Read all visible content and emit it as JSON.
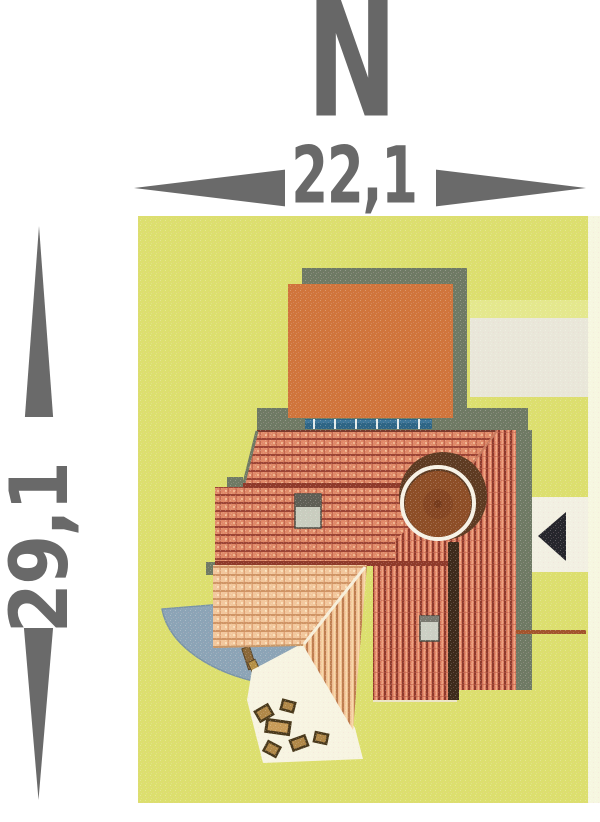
{
  "plan": {
    "north_indicator": {
      "label": "N"
    },
    "dimensions": {
      "width": {
        "value": "22,1"
      },
      "depth": {
        "value": "29,1"
      }
    },
    "icons": {
      "entrance_marker": "left-pointing black triangle",
      "dimension_arrows": "tapered gray triangles"
    },
    "colors": {
      "dimension_gray": "#6a6a6a",
      "grass_green": "#dcdf6e",
      "flat_roof_orange": "#d0753c",
      "roof_tile_red": "#d4755a",
      "roof_tile_peach": "#f2c79c",
      "building_shadow": "#6f7a64",
      "driveway_gray": "#e9e7d9",
      "driveway_band_yellow": "#e4e88d",
      "patio_blue": "#8ca4b6",
      "terrace_white": "#f7f4e1",
      "tower_roof_brown": "#8d4e27",
      "solar_panel_blue": "#2e6585",
      "entrance_marker_black": "#26262c",
      "access_line_brown": "#a2542c",
      "chimney_gray": "#c9cdbf"
    }
  }
}
